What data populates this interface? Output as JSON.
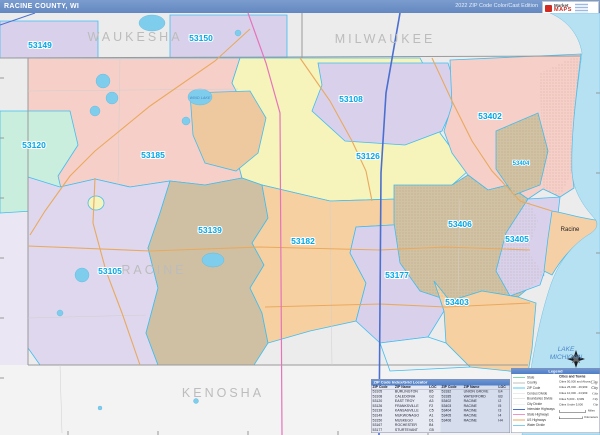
{
  "header": {
    "title": "RACINE COUNTY, WI",
    "edition": "2022 ZIP Code Color/Cast Edition",
    "logo": {
      "brand_top": "Market",
      "brand_bottom": "MAPS"
    }
  },
  "map": {
    "counties": [
      {
        "name": "WAUKESHA"
      },
      {
        "name": "MILWAUKEE"
      },
      {
        "name": "RACINE"
      },
      {
        "name": "KENOSHA"
      }
    ],
    "water_label_line1": "LAKE",
    "water_label_line2": "MICHIGAN",
    "wind_lake_label": "WIND LAKE",
    "city_label": "Racine",
    "zips": [
      {
        "code": "53149"
      },
      {
        "code": "53150"
      },
      {
        "code": "53120"
      },
      {
        "code": "53185"
      },
      {
        "code": "53108"
      },
      {
        "code": "53126"
      },
      {
        "code": "53402"
      },
      {
        "code": "53404"
      },
      {
        "code": "53406"
      },
      {
        "code": "53405"
      },
      {
        "code": "53139"
      },
      {
        "code": "53105"
      },
      {
        "code": "53182"
      },
      {
        "code": "53177"
      },
      {
        "code": "53403"
      }
    ],
    "region_colors": {
      "53149": "#d9d1ec",
      "53150": "#d9d1ec",
      "53120": "#c9eedd",
      "53185": "#f6cfc8",
      "53108": "#d9d1ec",
      "53126": "#f6f3bb",
      "53402": "#f6cfc8",
      "53404": "#d2c2a4",
      "53406": "#d2c2a4",
      "53405": "#d9d1ec",
      "53139": "#cfc0a4",
      "53105": "#ded7ee",
      "53182": "#f7d0a2",
      "53177": "#d9d1ec",
      "53403": "#f7d0a2",
      "53167": "#f6f3bb",
      "wind_lake_area": "#eec9a0",
      "racine_urban": "#f5cfa5"
    },
    "colors": {
      "lake": "#b5e1f3",
      "outside_county": "#ececec",
      "zip_boundary": "#3fbef0",
      "road_orange": "#e9a95e",
      "interstate_blue": "#4a6fd0",
      "highway_magenta": "#e673bb",
      "zip_label": "#00a7e8",
      "county_label": "#bcbcbc",
      "water_label": "#4a86c8"
    }
  },
  "table": {
    "title": "ZIP Code Index/Grid Locator",
    "columns": [
      "ZIP Code",
      "ZIP Name",
      "LOC"
    ],
    "rows_left": [
      [
        "53105",
        "BURLINGTON",
        "B5"
      ],
      [
        "53108",
        "CALEDONIA",
        "G2"
      ],
      [
        "53120",
        "EAST TROY",
        "A3"
      ],
      [
        "53126",
        "FRANKSVILLE",
        "F2"
      ],
      [
        "53139",
        "KANSASVILLE",
        "C5"
      ],
      [
        "53149",
        "MUKWONAGO",
        "A1"
      ],
      [
        "53150",
        "MUSKEGO",
        "D1"
      ],
      [
        "53167",
        "ROCHESTER",
        "B4"
      ],
      [
        "53177",
        "STURTEVANT",
        "G5"
      ]
    ],
    "rows_right": [
      [
        "53182",
        "UNION GROVE",
        "E4"
      ],
      [
        "53185",
        "WATERFORD",
        "B3"
      ],
      [
        "53402",
        "RACINE",
        "I2"
      ],
      [
        "53403",
        "RACINE",
        "I5"
      ],
      [
        "53404",
        "RACINE",
        "I3"
      ],
      [
        "53405",
        "RACINE",
        "I4"
      ],
      [
        "53406",
        "RACINE",
        "H4"
      ]
    ]
  },
  "legend": {
    "title": "Legend",
    "items": [
      {
        "label": "State",
        "color": "#7adba3",
        "weight": 2
      },
      {
        "label": "County",
        "color": "#bfbfbf",
        "weight": 2
      },
      {
        "label": "ZIP Code",
        "color": "#56c8f0",
        "weight": 2
      },
      {
        "label": "Census Divide",
        "color": "#d9d9d9",
        "weight": 1
      },
      {
        "label": "Boundaries Divide",
        "color": "#cccccc",
        "weight": 1
      },
      {
        "label": "City Divide",
        "color": "#e3e3e3",
        "weight": 1
      },
      {
        "label": "Interstate Highways",
        "color": "#4a6fd0",
        "weight": 2
      },
      {
        "label": "State Highways",
        "color": "#f092c8",
        "weight": 2
      },
      {
        "label": "US Highways",
        "color": "#e9a95e",
        "weight": 2
      },
      {
        "label": "Water Divide",
        "color": "#7ecdec",
        "weight": 2
      }
    ],
    "cities": {
      "heading": "Cities and Towns",
      "symbol": "City",
      "classes": [
        "Cities 50,000 and Above",
        "Cities 25,000 - 49,999",
        "Cities 10,000 - 24,999",
        "Cities 5,000 - 9,999",
        "Cities Under 5,000"
      ]
    },
    "scale_miles": "Miles",
    "scale_km": "Kilometers"
  }
}
